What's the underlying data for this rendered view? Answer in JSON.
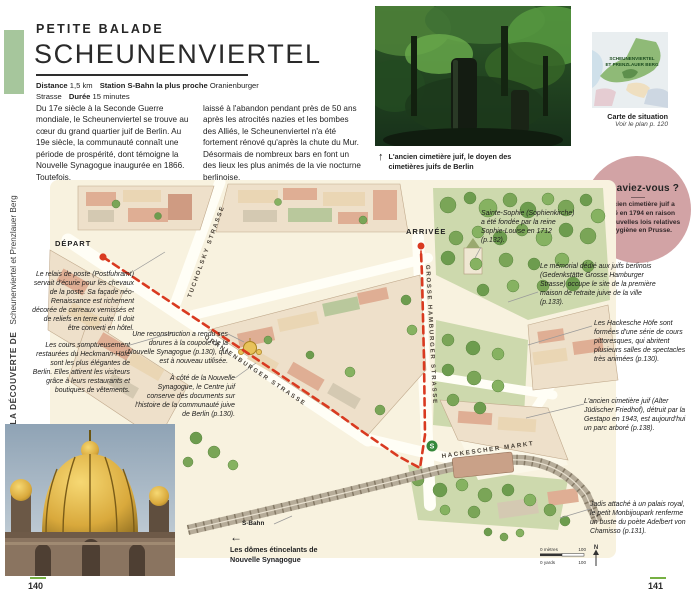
{
  "colors": {
    "accent_green": "#76b043",
    "sidebar_green": "#a6c69c",
    "didyouknow_pink": "#d2a3a5",
    "route_red": "#d93a20",
    "map_cream": "#f8f2df"
  },
  "pages": {
    "left_number": "140",
    "right_number": "141"
  },
  "sidebar": {
    "series": "À LA DÉCOUVERTE DE",
    "section": "Scheunenviertel et Prenzlauer Berg"
  },
  "header": {
    "kicker": "PETITE BALADE",
    "title": "SCHEUNENVIERTEL",
    "meta": [
      {
        "label": "Distance",
        "value": "1,5 km"
      },
      {
        "label": "Station S-Bahn la plus proche",
        "value": "Oranienburger Strasse"
      },
      {
        "label": "Durée",
        "value": "15 minutes"
      }
    ]
  },
  "intro": {
    "col1": "Du 17e siècle à la Seconde Guerre mondiale, le Scheunenviertel se trouve au cœur du grand quartier juif de Berlin. Au 19e siècle, la communauté connaît une période de prospérité, dont témoigne la Nouvelle Synagogue inaugurée en 1866. Toutefois,",
    "col2": "laissé à l'abandon pendant près de 50 ans après les atrocités nazies et les bombes des Alliés, le Scheunenviertel n'a été fortement rénové qu'après la chute du Mur. Désormais de nombreux bars en font un des lieux les plus animés de la vie nocturne berlinoise."
  },
  "photo_top": {
    "arrow": "↑",
    "caption": "L'ancien cimetière juif, le doyen des cimetières juifs de Berlin"
  },
  "situation": {
    "area_label_1": "SCHEUNENVIERTEL",
    "area_label_2": "ET PRENZLAUER BERG",
    "title": "Carte de situation",
    "subtitle": "Voir le plan p. 120"
  },
  "didyouknow": {
    "title": "Le saviez-vous ?",
    "body": "L'ancien cimetière juif a fermé en 1794 en raison des nouvelles lois relatives à l'hygiène en Prusse."
  },
  "map": {
    "depart_label": "DÉPART",
    "arrivee_label": "ARRIVÉE",
    "streets": {
      "tucholsky": "TUCHOLSKY STRASSE",
      "oranienburger": "ORANIENBURGER STRASSE",
      "grosse_hamburger": "GROSSE HAMBURGER STRASSE",
      "hackescher_markt": "HACKESCHER MARKT"
    },
    "sbahn_label": "S-Bahn",
    "sbahn_badge": "S",
    "scale": {
      "metres": "0 mètres",
      "yards": "0 yards",
      "value": "100",
      "north": "N"
    },
    "annotations": [
      {
        "text": "Le relais de poste (Postfuhramt) servait d'écurie pour les chevaux de la poste. Sa façade néo-Renaissance est richement décorée de carreaux vernissés et de reliefs en terre cuite. Il doit être converti en hôtel."
      },
      {
        "text": "Les cours somptueusement restaurées du Heckmann-Höfe sont les plus élégantes de Berlin. Elles attirent les visiteurs grâce à leurs restaurants et boutiques de vêtements."
      },
      {
        "text": "Une reconstruction a rendu ses dorures à la coupole de la Nouvelle Synagogue (p.130), qui est à nouveau utilisée."
      },
      {
        "text": "À côté de la Nouvelle Synagogue, le Centre juif conserve des documents sur l'histoire de la communauté juive de Berlin (p.130)."
      },
      {
        "text": "Sainte-Sophie (Sophienkirche) a été fondée par la reine Sophie-Louise en 1712 (p.132)."
      },
      {
        "text": "Le mémorial dédié aux juifs berlinois (Gedenkstätte Grosse Hamburger Strasse) occupe le site de la première maison de retraite juive de la ville (p.133)."
      },
      {
        "text": "Les Hackesche Höfe sont formées d'une série de cours pittoresques, qui abritent plusieurs salles de spectacles très animées (p.130)."
      },
      {
        "text": "L'ancien cimetière juif (Alter Jüdischer Friedhof), détruit par la Gestapo en 1943, est aujourd'hui un parc arboré (p.138)."
      },
      {
        "text": "Jadis attaché à un palais royal, le petit Monbijoupark renferme un buste du poète Adelbert von Chamisso (p.131)."
      }
    ]
  },
  "photo_bottom": {
    "arrow": "←",
    "caption": "Les dômes étincelants de Nouvelle Synagogue"
  }
}
